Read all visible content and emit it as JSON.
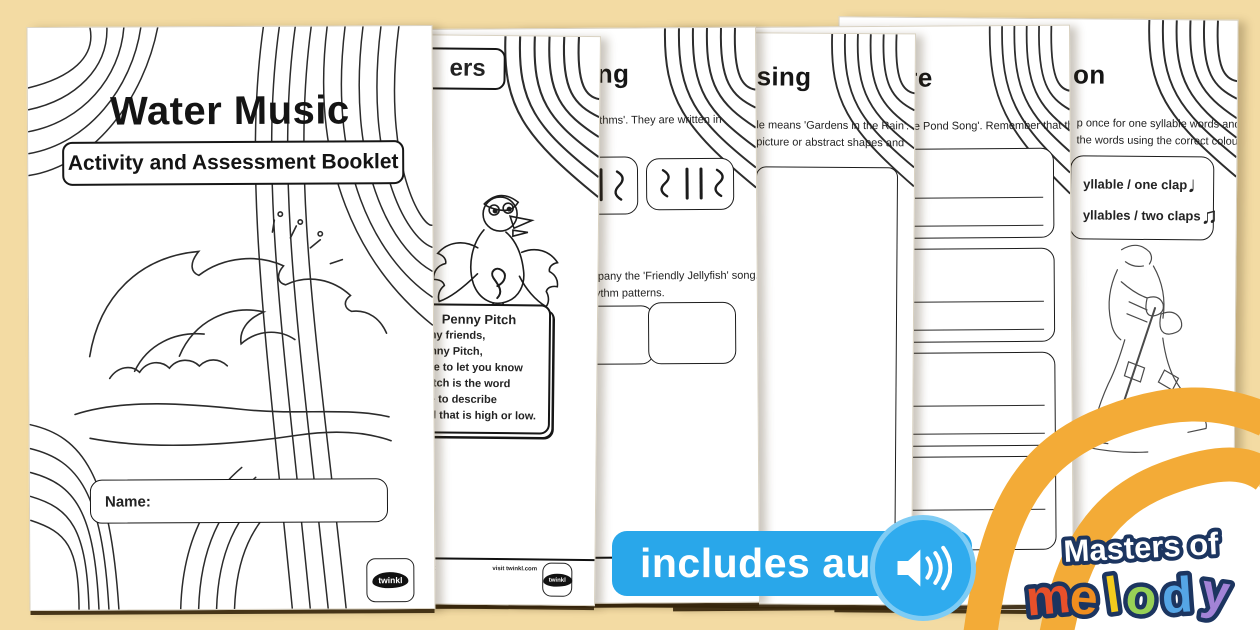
{
  "brand": {
    "name": "twinkl",
    "link_text": "visit twinkl.com"
  },
  "colors": {
    "background": "#f3dba3",
    "page": "#ffffff",
    "ink": "#232323",
    "ribbon": "#f3ab37",
    "badge_blue": "#29a7ea",
    "badge_ring": "#7fccf4",
    "logo_outline": "#1c3560"
  },
  "cover": {
    "title": "Water Music",
    "subtitle": "Activity and Assessment Booklet",
    "name_label": "Name:"
  },
  "page2": {
    "title_fragment": "ers",
    "character_name": "Penny Pitch",
    "speech_lines": [
      "o my friends,",
      "Penny Pitch,",
      "here to let you know",
      "t pitch is the word",
      "use to describe",
      "und that is high or low."
    ],
    "footer_left_fragment": "klet"
  },
  "page3": {
    "title_fragment": "ing",
    "intro_fragment": "hythms'. They are written in",
    "task_fragment_1": "mpany the 'Friendly Jellyfish' song.",
    "task_fragment_2": "hythm patterns.",
    "footer_fragment": "ble"
  },
  "page4": {
    "title_fragment": "sing",
    "intro_fragment_1": "le means 'Gardens in the Rain'.",
    "intro_fragment_2": "picture or abstract shapes and"
  },
  "page5": {
    "title_fragment": "re",
    "intro_fragment": "he Pond Song'. Remember that the"
  },
  "page6": {
    "title_fragment": "on",
    "intro_fragment_1": "p once for one syllable words and",
    "intro_fragment_2": "the words using the correct colour",
    "legend": [
      {
        "label": "yllable / one clap",
        "note": "♩"
      },
      {
        "label": "yllables / two claps",
        "note": "♫"
      }
    ]
  },
  "audio_badge": {
    "label": "includes audio!"
  },
  "logo": {
    "line1": "Masters of",
    "letters": [
      {
        "ch": "m",
        "color": "#e8502a"
      },
      {
        "ch": "e",
        "color": "#ef8d1f"
      },
      {
        "ch": "l",
        "color": "#f3cb1d"
      },
      {
        "ch": "o",
        "color": "#97d156"
      },
      {
        "ch": "d",
        "color": "#55a5e5"
      },
      {
        "ch": "y",
        "color": "#a283d6"
      }
    ]
  }
}
